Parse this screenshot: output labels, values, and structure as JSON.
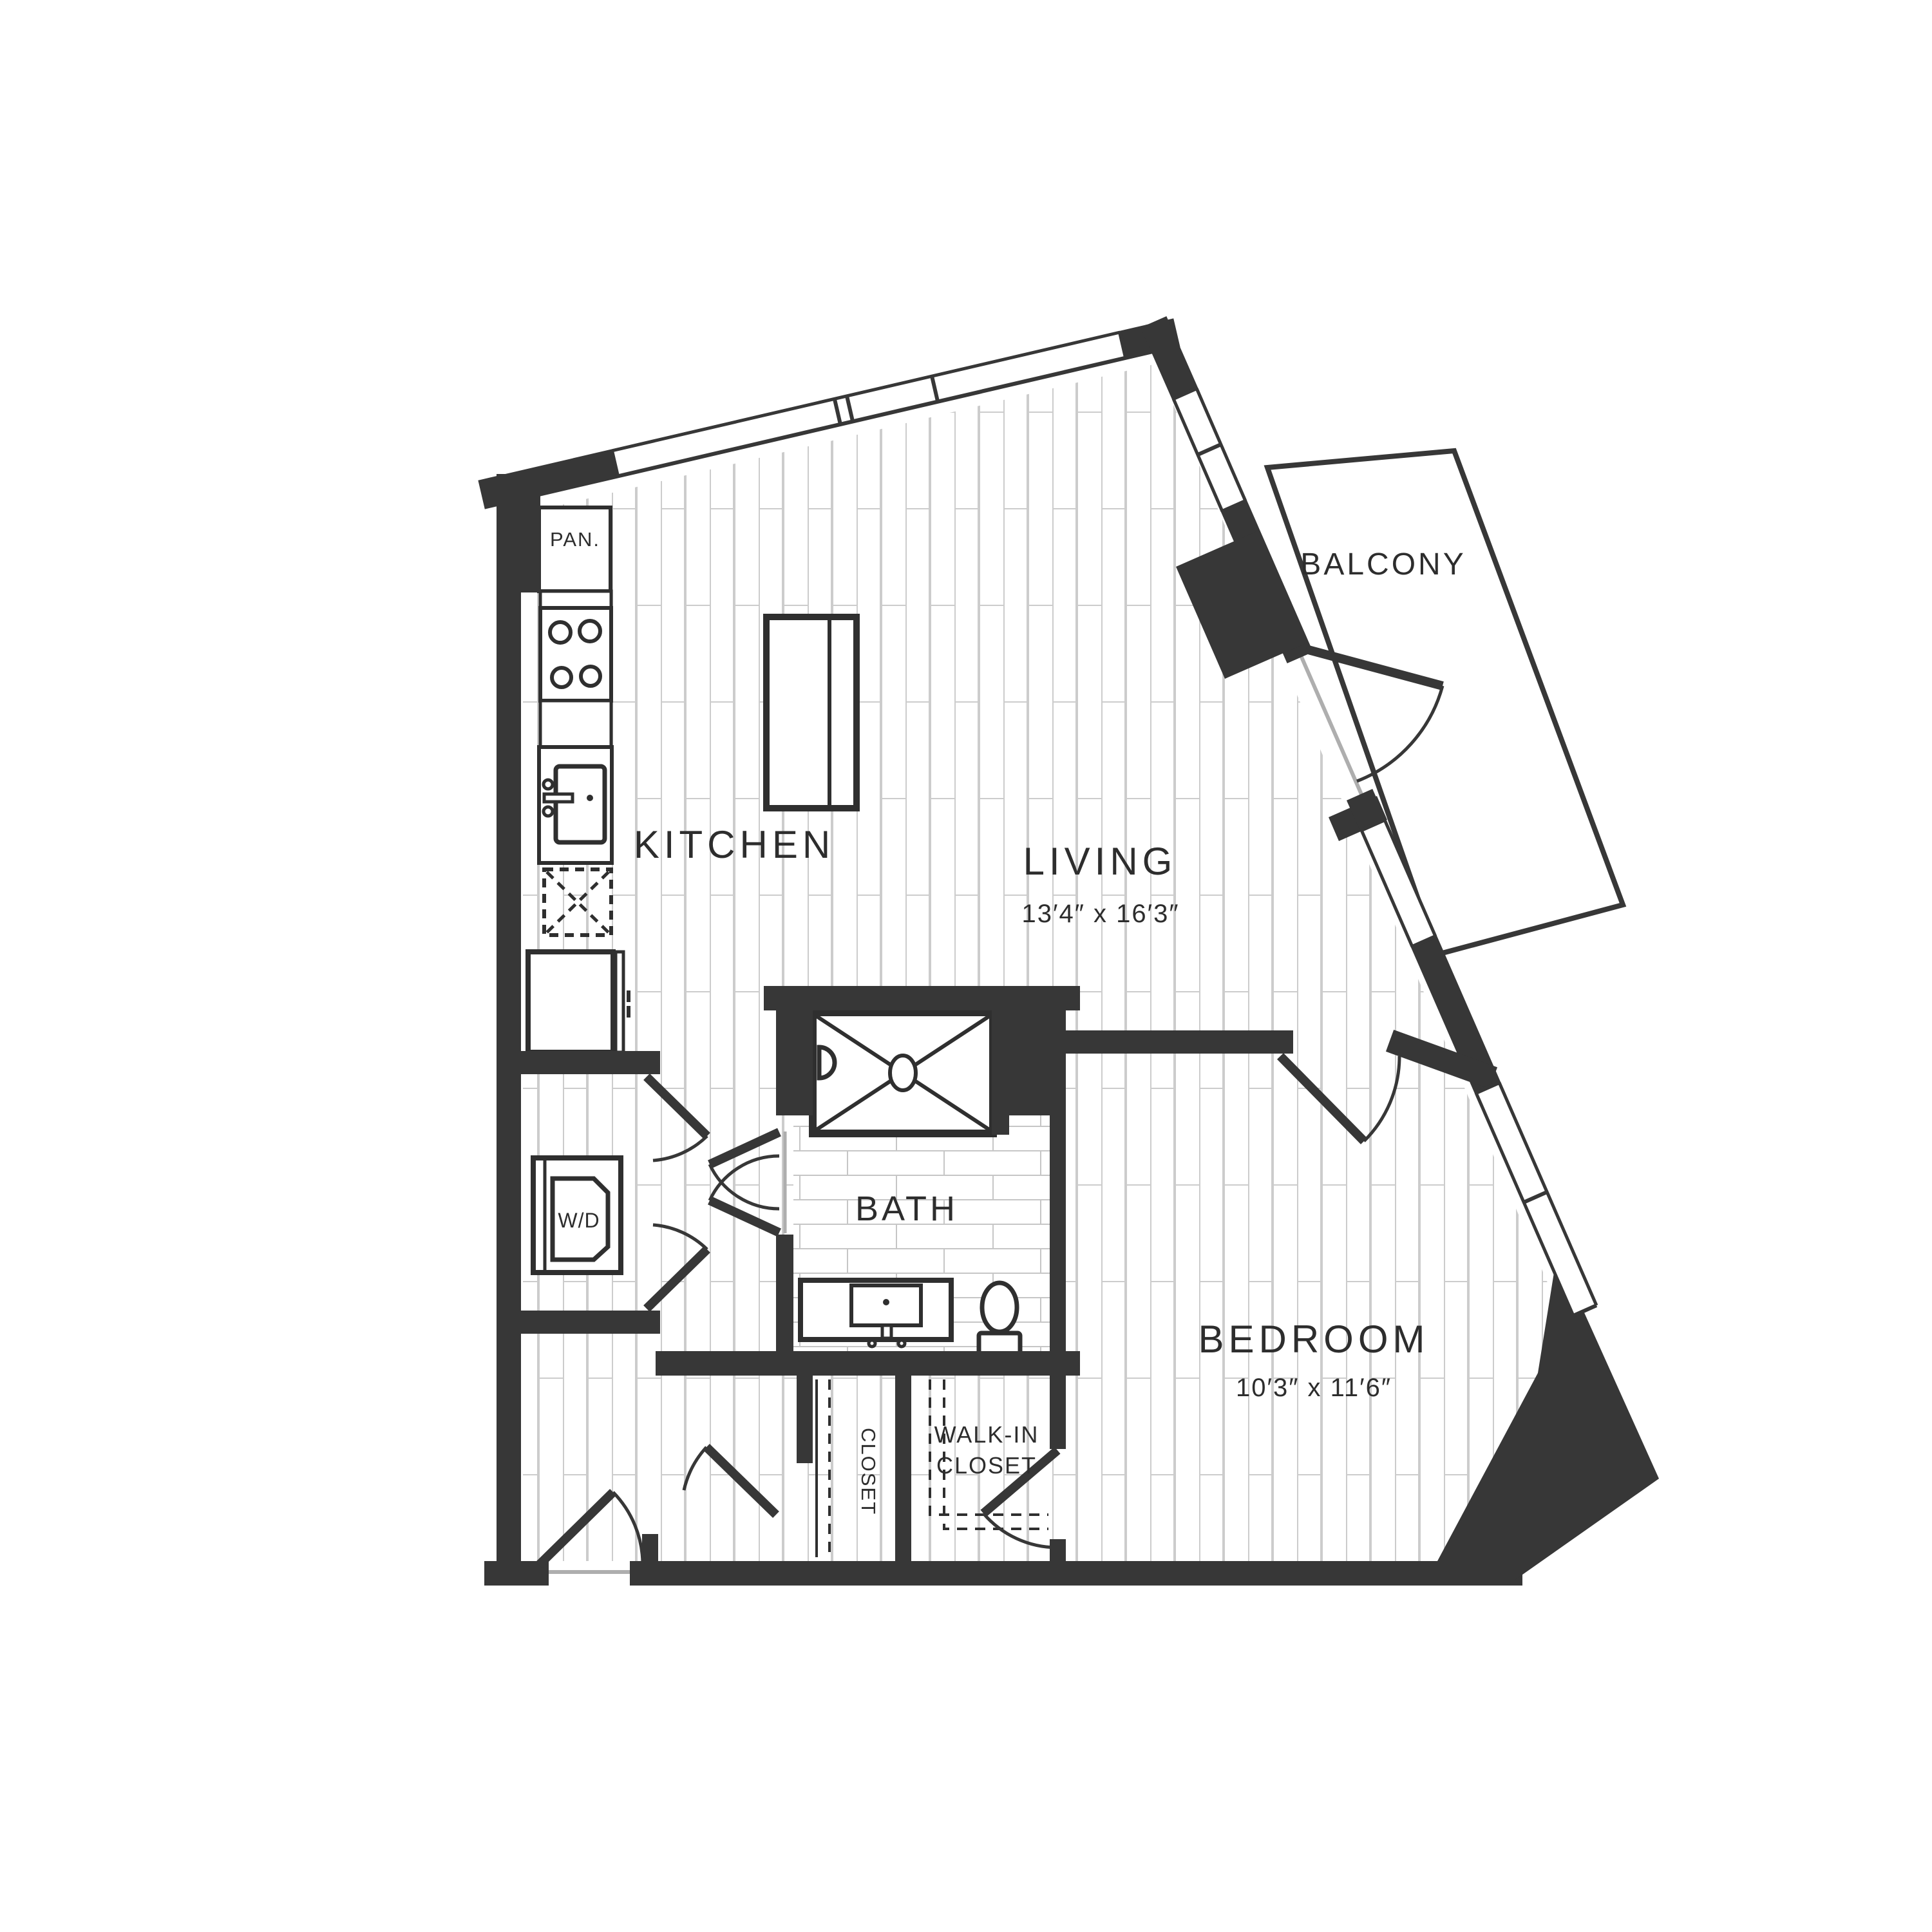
{
  "plan": {
    "type": "apartment-floor-plan",
    "rooms": {
      "pantry": {
        "label": "PAN."
      },
      "kitchen": {
        "label": "KITCHEN"
      },
      "living": {
        "label": "LIVING",
        "dims": "13′4″ x 16′3″"
      },
      "balcony": {
        "label": "BALCONY"
      },
      "bath": {
        "label": "BATH"
      },
      "bedroom": {
        "label": "BEDROOM",
        "dims": "10′3″ x 11′6″"
      },
      "laundry": {
        "label": "W/D"
      },
      "closet": {
        "label": "CLOSET"
      },
      "walk_in_closet": {
        "line1": "WALK-IN",
        "line2": "CLOSET"
      }
    },
    "colors": {
      "wall": "#373737",
      "text": "#2d2d2d",
      "plank_line": "#cccccc",
      "brick_line": "#c6c6c6",
      "threshold": "#aeaeae",
      "background": "#ffffff"
    }
  }
}
